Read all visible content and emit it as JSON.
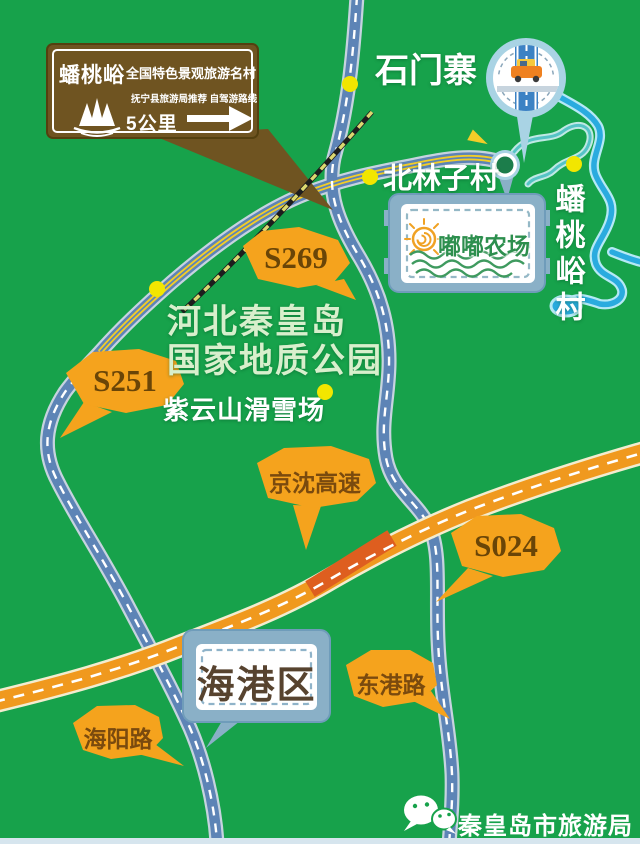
{
  "map": {
    "labels": {
      "shimenzhai": "石门寨",
      "beilinzicun": "北林子村",
      "pantaoyucun": "蟠桃峪村",
      "geopark_line1": "河北秦皇岛",
      "geopark_line2": "国家地质公园",
      "ziyunshan": "紫云山滑雪场"
    },
    "callouts": {
      "s269": "S269",
      "s251": "S251",
      "s024": "S024",
      "jingshen": "京沈高速",
      "donggang": "东港路",
      "haiyang": "海阳路"
    },
    "district_sign": "海港区",
    "farm_sign": "嘟嘟农场",
    "guide_sign": {
      "name": "蟠桃峪",
      "title": "全国特色景观旅游名村",
      "recommendation": "抚宁县旅游局推荐 自驾游路线",
      "distance": "5公里"
    },
    "icons": {
      "viewpoint": "bridge-with-car-bubble",
      "direction_arrows": "yellow-arrowheads",
      "wechat": "wechat-bubbles",
      "sign_logo": "mountain-peaks"
    },
    "colors": {
      "background_green": "#17a24b",
      "callout_orange": "#f5a31d",
      "highway_orange": "#f0991e",
      "highway_bridge_red": "#de5e1f",
      "road_blue": "#5d84b6",
      "scenic_stripe_yellow": "#f2cd28",
      "river_blue": "#2aabdf",
      "guide_sign_brown": "#6f5421",
      "frame_blue": "#8ab0c7",
      "poi_dot_yellow": "#f2e600"
    },
    "footer": "秦皇岛市旅游局"
  }
}
